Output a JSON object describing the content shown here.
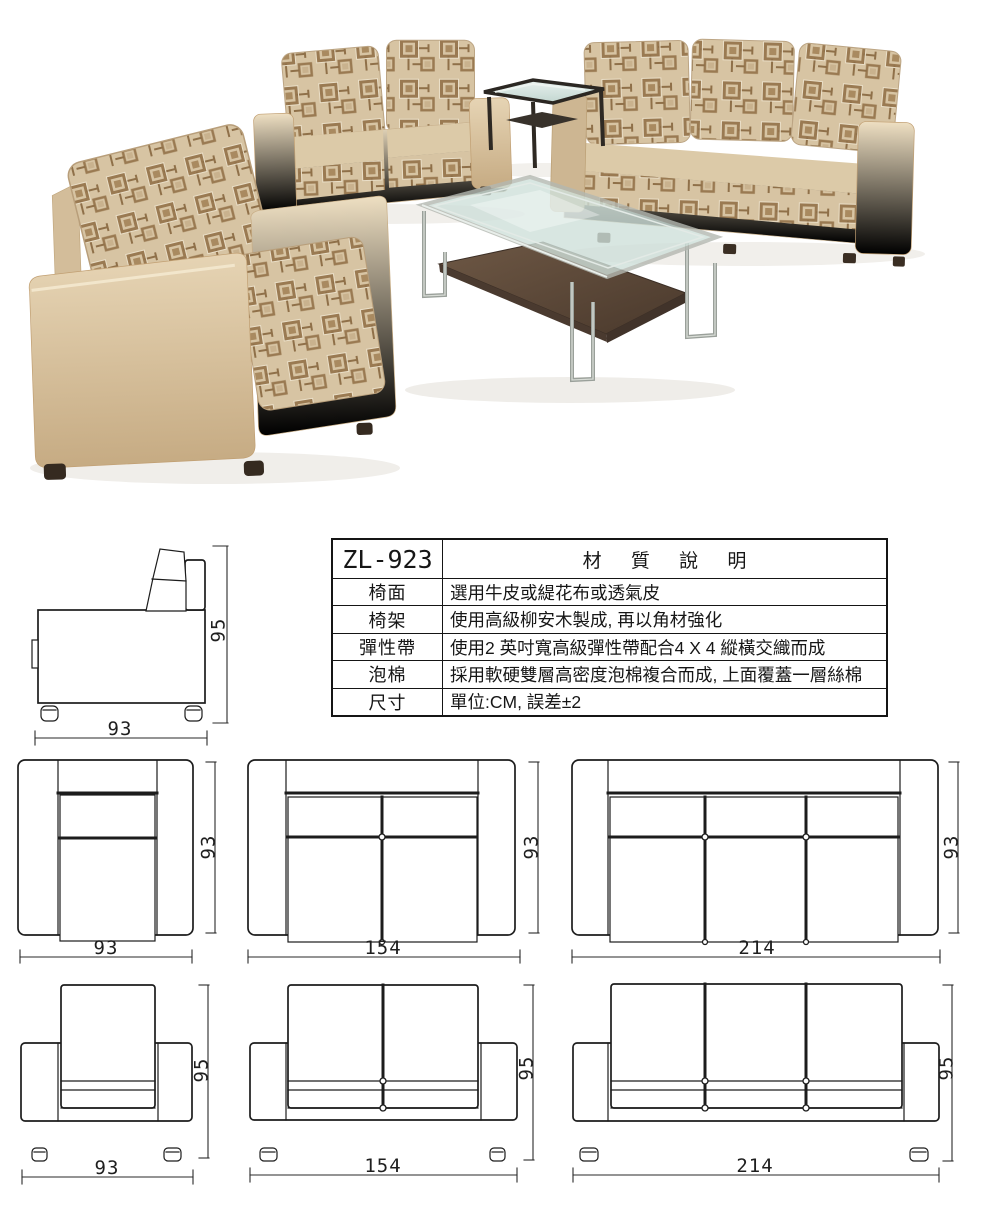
{
  "spec_table": {
    "model": "ZL-923",
    "title": "材 質 說 明",
    "rows": [
      {
        "label": "椅面",
        "value": "選用牛皮或緹花布或透氣皮"
      },
      {
        "label": "椅架",
        "value": "使用高級柳安木製成, 再以角材強化"
      },
      {
        "label": "彈性帶",
        "value": "使用2 英吋寬高級彈性帶配合4 X 4 縱橫交織而成"
      },
      {
        "label": "泡棉",
        "value": "採用軟硬雙層高密度泡棉複合而成, 上面覆蓋一層絲棉"
      },
      {
        "label": "尺寸",
        "value": "單位:CM, 誤差±2"
      }
    ]
  },
  "drawings": {
    "side_view": {
      "width": "93",
      "height": "95"
    },
    "top_views": [
      {
        "width": "93",
        "height": "93"
      },
      {
        "width": "154",
        "height": "93"
      },
      {
        "width": "214",
        "height": "93"
      }
    ],
    "front_views": [
      {
        "width": "93",
        "height": "95"
      },
      {
        "width": "154",
        "height": "95"
      },
      {
        "width": "214",
        "height": "95"
      }
    ]
  },
  "colors": {
    "line": "#1c1c1c",
    "leather": "#dcc6a8",
    "leather_light": "#eedfc2",
    "fabric_base": "#d7c4a3",
    "fabric_motif": "#9a7a52",
    "glass": "#cfe0da",
    "steel": "#9aa09a",
    "wood": "#5d4938",
    "feet": "#3a2e23"
  }
}
